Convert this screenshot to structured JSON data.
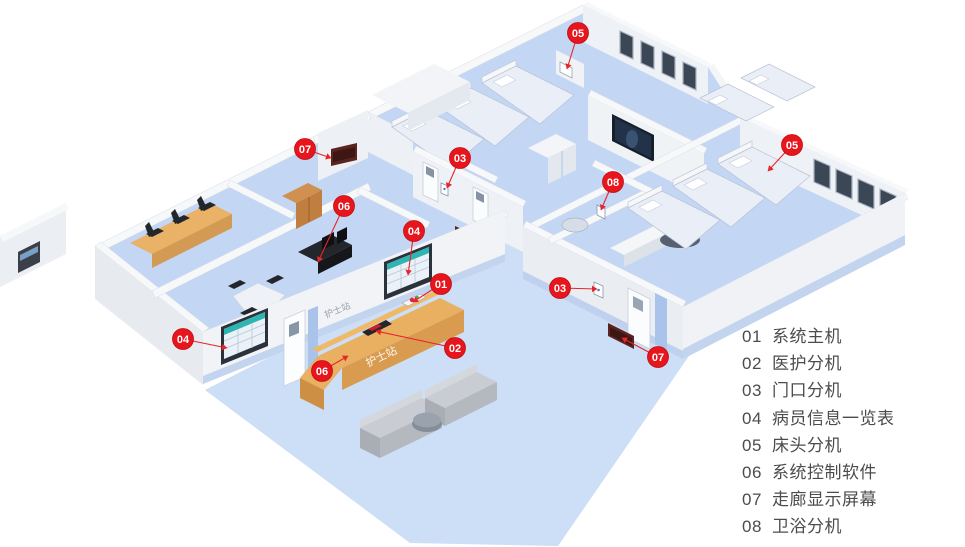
{
  "diagram": {
    "type": "isometric-floorplan",
    "subject": "hospital nurse-call system ward layout"
  },
  "palette": {
    "marker_red": "#e7151c",
    "marker_red_edge": "#c10d12",
    "leader_line": "#e8252b",
    "legend_text": "#4c4c4c",
    "floor_blue": "#c3d6f3",
    "lobby_blue": "#cddef7",
    "wall_white": "#f7f8fa",
    "wall_face": "#eef1f5",
    "baseboard_blue": "#c3d4ef",
    "wood_desk": "#e8b060",
    "corridor_display_red": "#5c2420",
    "window_glass": "#3c4755",
    "teal_header": "#2fb5b1",
    "tv_screen": "#16202c"
  },
  "legend": {
    "items": [
      {
        "num": "01",
        "label": "系统主机"
      },
      {
        "num": "02",
        "label": "医护分机"
      },
      {
        "num": "03",
        "label": "门口分机"
      },
      {
        "num": "04",
        "label": "病员信息一览表"
      },
      {
        "num": "05",
        "label": "床头分机"
      },
      {
        "num": "06",
        "label": "系统控制软件"
      },
      {
        "num": "07",
        "label": "走廊显示屏幕"
      },
      {
        "num": "08",
        "label": "卫浴分机"
      }
    ]
  },
  "markers": [
    {
      "num": "05",
      "label": "床头分机",
      "x": 578,
      "y": 33,
      "tx": 567,
      "ty": 69
    },
    {
      "num": "07",
      "label": "走廊显示屏幕",
      "x": 305,
      "y": 149,
      "tx": 331,
      "ty": 158
    },
    {
      "num": "03",
      "label": "门口分机",
      "x": 460,
      "y": 158,
      "tx": 447,
      "ty": 188
    },
    {
      "num": "08",
      "label": "卫浴分机",
      "x": 613,
      "y": 182,
      "tx": 601,
      "ty": 210
    },
    {
      "num": "05",
      "label": "床头分机",
      "x": 792,
      "y": 145,
      "tx": 768,
      "ty": 171
    },
    {
      "num": "06",
      "label": "系统控制软件",
      "x": 344,
      "y": 206,
      "tx": 318,
      "ty": 262
    },
    {
      "num": "04",
      "label": "病员信息一览表",
      "x": 414,
      "y": 231,
      "tx": 408,
      "ty": 275
    },
    {
      "num": "01",
      "label": "系统主机",
      "x": 441,
      "y": 284,
      "tx": 413,
      "ty": 302
    },
    {
      "num": "03",
      "label": "门口分机",
      "x": 560,
      "y": 288,
      "tx": 597,
      "ty": 289
    },
    {
      "num": "02",
      "label": "医护分机",
      "x": 455,
      "y": 348,
      "tx": 376,
      "ty": 331
    },
    {
      "num": "04",
      "label": "病员信息一览表",
      "x": 183,
      "y": 339,
      "tx": 227,
      "ty": 348
    },
    {
      "num": "06",
      "label": "系统控制软件",
      "x": 322,
      "y": 371,
      "tx": 348,
      "ty": 356
    },
    {
      "num": "07",
      "label": "走廊显示屏幕",
      "x": 658,
      "y": 357,
      "tx": 622,
      "ty": 338
    }
  ],
  "labels": {
    "nurse_station_wall": "护士站",
    "nurse_station_desk": "护士站"
  }
}
